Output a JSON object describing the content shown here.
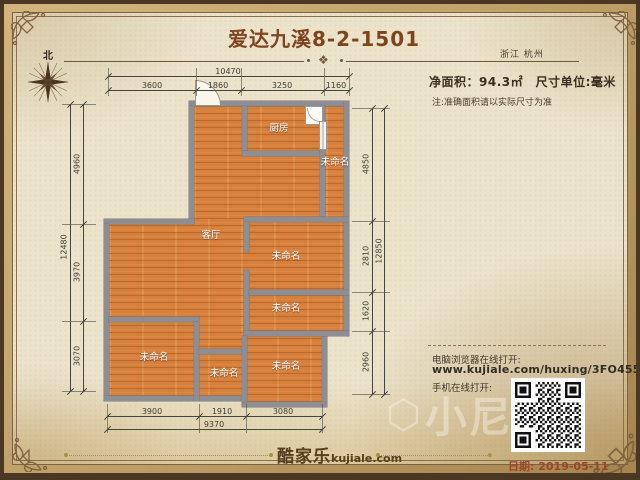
{
  "header": {
    "title": "爱达九溪8-2-1501",
    "region": "浙江 杭州",
    "north": "北",
    "area_line": "净面积：94.3㎡　尺寸单位:毫米",
    "note": "注:准确面积请以实际尺寸为准",
    "divider_ornament": "❖"
  },
  "plan": {
    "rooms": [
      {
        "label": "厨房"
      },
      {
        "label": "未命名"
      },
      {
        "label": "客厅"
      },
      {
        "label": "未命名"
      },
      {
        "label": "未命名"
      },
      {
        "label": "未命名"
      },
      {
        "label": "未命名"
      },
      {
        "label": "未命名"
      }
    ],
    "dims": {
      "top": {
        "total": "10470",
        "segments": [
          "3600",
          "1860",
          "3250",
          "1160"
        ]
      },
      "left": {
        "total": "12480",
        "segments": [
          "4960",
          "3970",
          "3070"
        ]
      },
      "right": {
        "total": "12850",
        "segments": [
          "4850",
          "2810",
          "1620",
          "2960"
        ]
      },
      "bottom": {
        "total": "9370",
        "segments": [
          "3900",
          "1910",
          "3080"
        ]
      }
    }
  },
  "footer": {
    "pc_label": "电脑浏览器在线打开:",
    "pc_url": "www.kujiale.com/huxing/3FO455TI3KE0",
    "mobile_label": "手机在线打开:",
    "date": "日期: 2019-05-11",
    "brand": "酷家乐",
    "brand_site": "kujiale.com",
    "watermark": "小尼"
  },
  "colors": {
    "title": "#7e441f",
    "floor": "#d6803d",
    "wall": "#8e8e92",
    "date": "#9a452c",
    "parchment": "#ece3cb",
    "gold_band": "#b89a62"
  }
}
